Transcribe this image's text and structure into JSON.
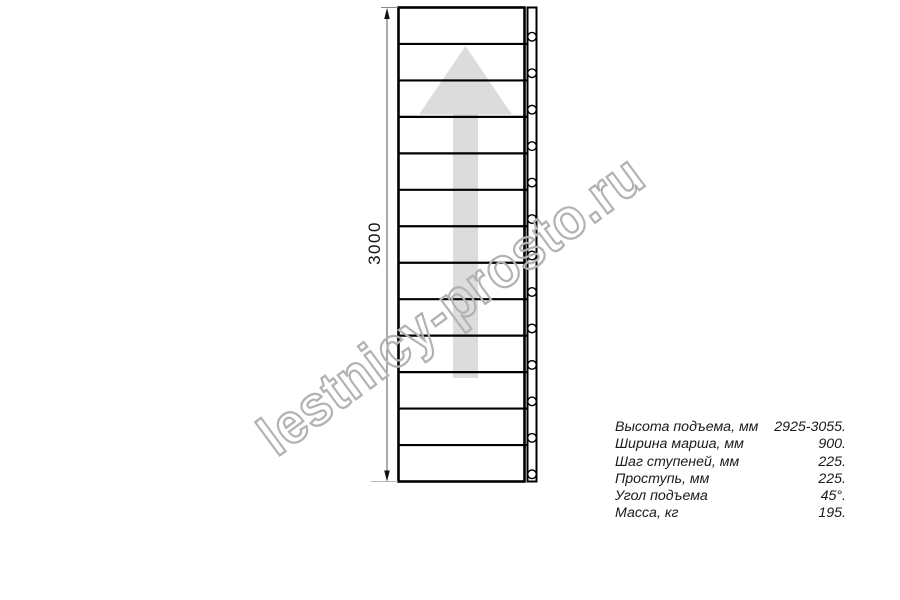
{
  "drawing": {
    "dimension_label": "3000",
    "step_count": 13,
    "watermark_text": "lestnicy-prosto.ru",
    "colors": {
      "line": "#000000",
      "arrow_fill": "#dcdcdc",
      "watermark_stroke": "#b2b2b2",
      "dimension_line": "#555555"
    }
  },
  "specs": {
    "rows": [
      {
        "label": "Высота подъема, мм",
        "value": "2925-3055."
      },
      {
        "label": "Ширина марша, мм",
        "value": "900."
      },
      {
        "label": "Шаг ступеней, мм",
        "value": "225."
      },
      {
        "label": "Проступь, мм",
        "value": "225."
      },
      {
        "label": "Угол подъема",
        "value": "45°."
      },
      {
        "label": "Масса, кг",
        "value": "195."
      }
    ]
  }
}
